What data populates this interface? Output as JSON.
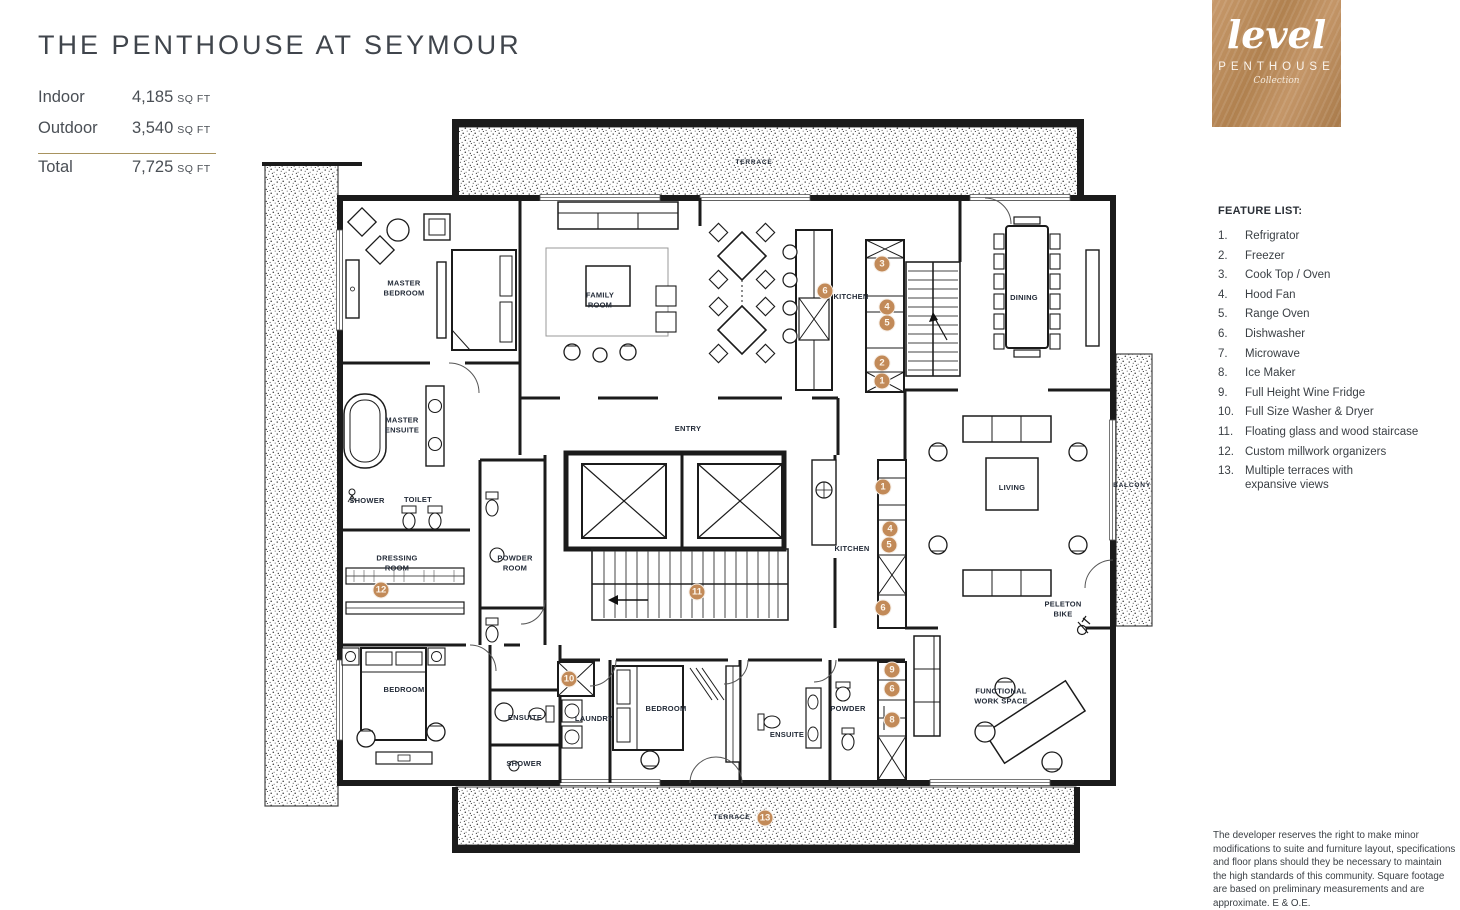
{
  "header": {
    "title": "THE PENTHOUSE AT SEYMOUR"
  },
  "stats": {
    "rows": [
      {
        "label": "Indoor",
        "value": "4,185",
        "unit": "SQ FT"
      },
      {
        "label": "Outdoor",
        "value": "3,540",
        "unit": "SQ FT"
      },
      {
        "label": "Total",
        "value": "7,725",
        "unit": "SQ FT"
      }
    ]
  },
  "logo": {
    "brand": "level",
    "line1": "PENTHOUSE",
    "line2": "Collection"
  },
  "feature_list": {
    "heading": "FEATURE LIST:",
    "items": [
      {
        "num": "1.",
        "text": "Refrigrator"
      },
      {
        "num": "2.",
        "text": "Freezer"
      },
      {
        "num": "3.",
        "text": "Cook Top / Oven"
      },
      {
        "num": "4.",
        "text": "Hood Fan"
      },
      {
        "num": "5.",
        "text": "Range Oven"
      },
      {
        "num": "6.",
        "text": "Dishwasher"
      },
      {
        "num": "7.",
        "text": "Microwave"
      },
      {
        "num": "8.",
        "text": "Ice Maker"
      },
      {
        "num": "9.",
        "text": "Full Height Wine Fridge"
      },
      {
        "num": "10.",
        "text": "Full Size Washer & Dryer"
      },
      {
        "num": "11.",
        "text": "Floating glass and wood staircase"
      },
      {
        "num": "12.",
        "text": "Custom millwork organizers"
      },
      {
        "num": "13.",
        "text": "Multiple terraces with\nexpansive views"
      }
    ]
  },
  "disclaimer": "The developer reserves the right to make minor modifications to suite and furniture layout, specifications and floor plans should they be necessary to maintain the high standards of this community. Square footage are based on preliminary measurements and are approximate. E & O.E.",
  "plan": {
    "colors": {
      "marker": "#c28a58",
      "wall": "#1b1b1b",
      "label": "#232b38",
      "divider": "#a8935f"
    },
    "room_labels": [
      {
        "text": "TERRACE",
        "x": 754,
        "y": 163,
        "small": true
      },
      {
        "text": "TERRACE",
        "x": 732,
        "y": 818,
        "small": true
      },
      {
        "text": "BALCONY",
        "x": 1132,
        "y": 486,
        "small": true
      },
      {
        "text": "MASTER\nBEDROOM",
        "x": 404,
        "y": 288
      },
      {
        "text": "FAMILY\nROOM",
        "x": 600,
        "y": 300
      },
      {
        "text": "KITCHEN",
        "x": 851,
        "y": 297
      },
      {
        "text": "DINING",
        "x": 1024,
        "y": 298
      },
      {
        "text": "ENTRY",
        "x": 688,
        "y": 429
      },
      {
        "text": "MASTER\nENSUITE",
        "x": 402,
        "y": 425
      },
      {
        "text": "SHOWER",
        "x": 367,
        "y": 501
      },
      {
        "text": "TOILET",
        "x": 418,
        "y": 500
      },
      {
        "text": "DRESSING\nROOM",
        "x": 397,
        "y": 563
      },
      {
        "text": "POWDER\nROOM",
        "x": 515,
        "y": 563
      },
      {
        "text": "KITCHEN",
        "x": 852,
        "y": 549
      },
      {
        "text": "LIVING",
        "x": 1012,
        "y": 488
      },
      {
        "text": "PELETON\nBIKE",
        "x": 1063,
        "y": 609
      },
      {
        "text": "BEDROOM",
        "x": 404,
        "y": 690
      },
      {
        "text": "ENSUITE",
        "x": 525,
        "y": 718
      },
      {
        "text": "SHOWER",
        "x": 524,
        "y": 764
      },
      {
        "text": "LAUNDRY",
        "x": 594,
        "y": 719
      },
      {
        "text": "BEDROOM",
        "x": 666,
        "y": 709
      },
      {
        "text": "ENSUITE",
        "x": 787,
        "y": 735
      },
      {
        "text": "POWDER",
        "x": 848,
        "y": 709
      },
      {
        "text": "FUNCTIONAL\nWORK SPACE",
        "x": 1001,
        "y": 696
      }
    ],
    "markers": [
      {
        "n": "3",
        "x": 882,
        "y": 264
      },
      {
        "n": "6",
        "x": 825,
        "y": 291
      },
      {
        "n": "4",
        "x": 887,
        "y": 307
      },
      {
        "n": "5",
        "x": 887,
        "y": 323
      },
      {
        "n": "2",
        "x": 882,
        "y": 363
      },
      {
        "n": "1",
        "x": 882,
        "y": 381
      },
      {
        "n": "1",
        "x": 883,
        "y": 487
      },
      {
        "n": "4",
        "x": 890,
        "y": 529
      },
      {
        "n": "5",
        "x": 889,
        "y": 545
      },
      {
        "n": "6",
        "x": 883,
        "y": 608
      },
      {
        "n": "11",
        "x": 697,
        "y": 592
      },
      {
        "n": "12",
        "x": 381,
        "y": 590
      },
      {
        "n": "10",
        "x": 569,
        "y": 679
      },
      {
        "n": "9",
        "x": 892,
        "y": 670
      },
      {
        "n": "6",
        "x": 892,
        "y": 689
      },
      {
        "n": "8",
        "x": 892,
        "y": 720
      },
      {
        "n": "13",
        "x": 765,
        "y": 818
      }
    ]
  }
}
